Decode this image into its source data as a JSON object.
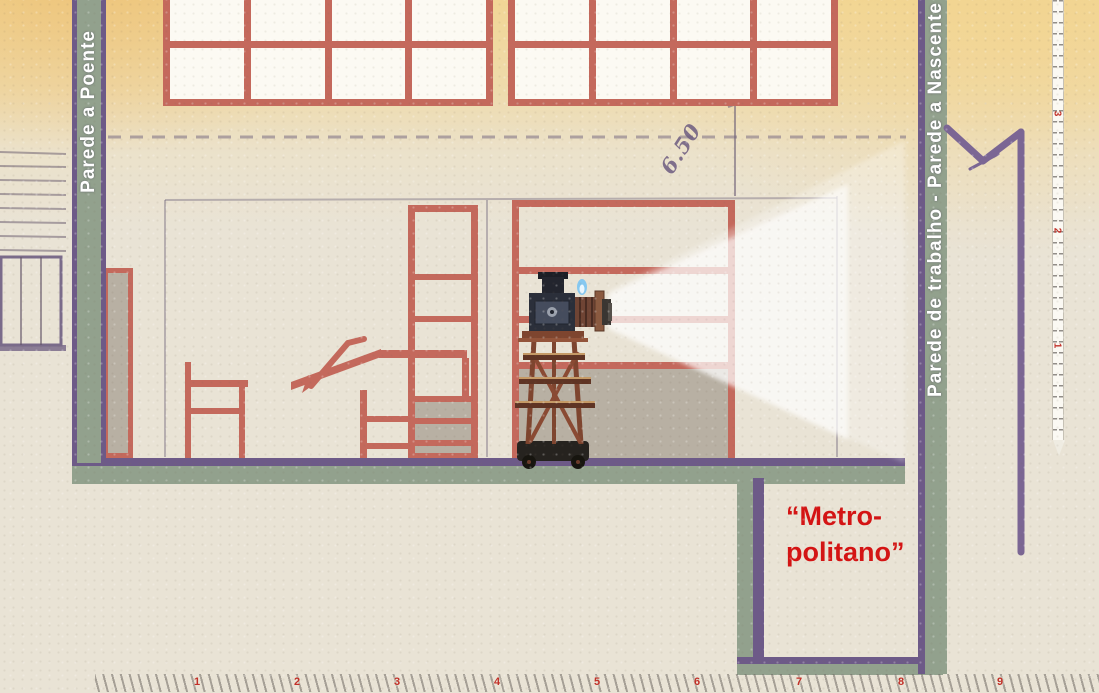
{
  "labels": {
    "left_wall": "Parede a Poente",
    "right_wall": "Parede de trabalho - Parede a Nascente",
    "metropolitano_line1": "“Metro-",
    "metropolitano_line2": "politano”",
    "dimension_height": "6.50"
  },
  "rulers": {
    "bottom_numbers": [
      "1",
      "2",
      "3",
      "4",
      "5",
      "6",
      "7",
      "8",
      "9"
    ],
    "right_numbers": [
      "3",
      "2",
      "1"
    ]
  },
  "colors": {
    "paper": "#e9e3d5",
    "frame_salmon": "#c4695c",
    "wall_green": "#92a18d",
    "wall_purple": "#6d5a88",
    "annotation_red": "#d41414",
    "gray_fill": "#b8b0a3"
  },
  "objects": {
    "projector": "magic-lantern-projector-on-stand",
    "beam": "projection-light-beam",
    "chair": "chair-section-silhouette",
    "table": "drafting-table-silhouette",
    "rack": "shelf-ladder-rack",
    "door": "door-panel",
    "screen": "projection-screen"
  }
}
